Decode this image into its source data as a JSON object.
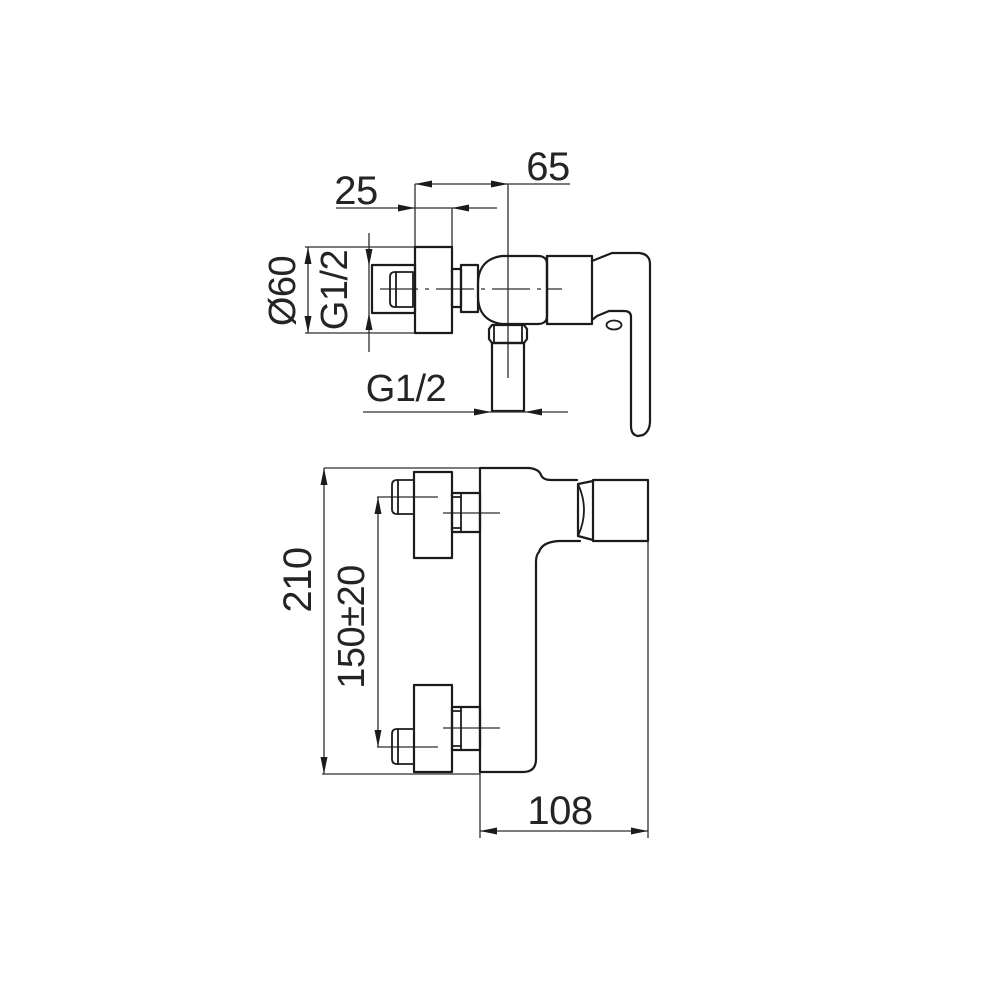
{
  "drawing": {
    "product": "wall-mounted single-lever shower mixer",
    "kind": "technical dimension drawing",
    "units": "mm",
    "line_color": "#1b1b1b",
    "background_color": "#ffffff",
    "top_view": {
      "name": "top view",
      "dimensions": [
        {
          "id": "wall-to-body-center",
          "value": "65"
        },
        {
          "id": "flange-depth",
          "value": "25"
        },
        {
          "id": "flange-diameter",
          "value": "Ø60"
        },
        {
          "id": "inlet-thread",
          "value": "G1/2"
        },
        {
          "id": "shower-outlet-thread",
          "value": "G1/2"
        }
      ]
    },
    "front_view": {
      "name": "front view",
      "dimensions": [
        {
          "id": "overall-height",
          "value": "210"
        },
        {
          "id": "connection-spacing",
          "value": "150±20"
        },
        {
          "id": "overall-depth",
          "value": "108"
        }
      ]
    }
  }
}
